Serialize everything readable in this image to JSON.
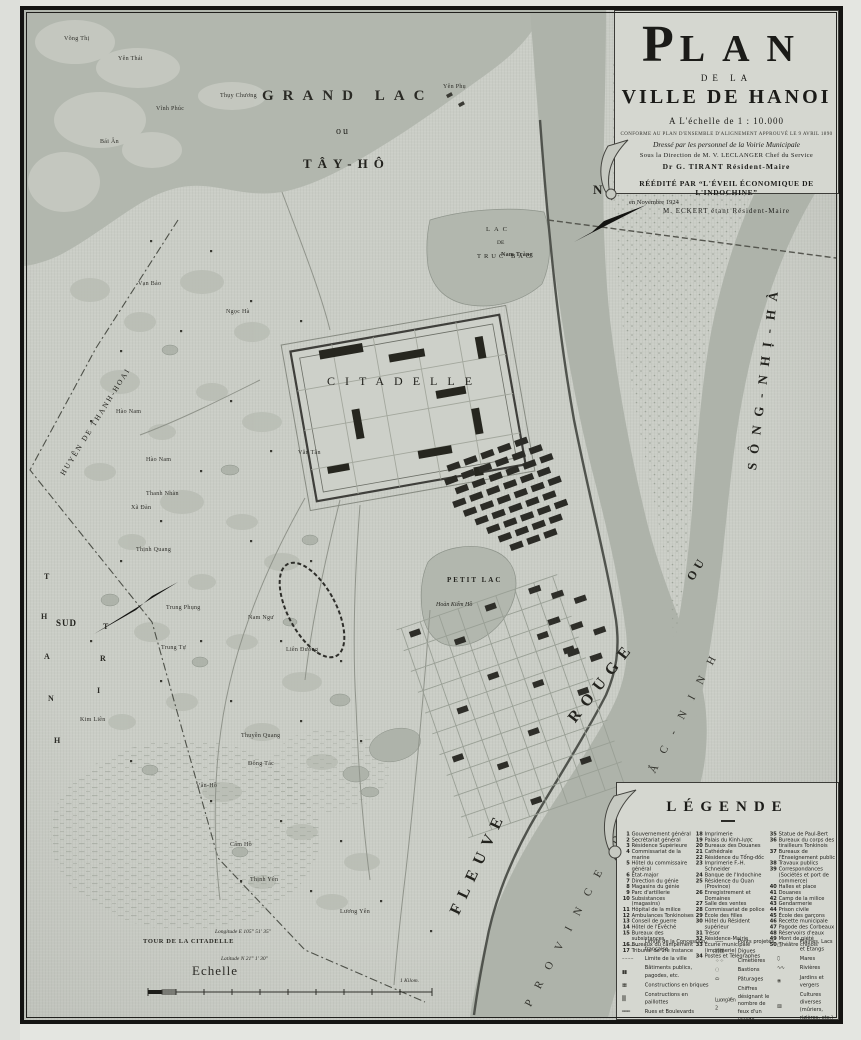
{
  "title_block": {
    "plan_initial": "P",
    "plan_rest": "LAN",
    "de_la": "DE LA",
    "ville": "VILLE DE HANOI",
    "scale_line": "A L'échelle de 1 : 10.000",
    "conforme": "CONFORME AU PLAN D'ENSEMBLE D'ALIGNEMENT APPROUVÉ LE 9 AVRIL 1890",
    "dresse": "Dressé par les personnel de la Voirie Municipale",
    "direction": "Sous la Direction de M. V. LECLANGER Chef du Service",
    "tirant": "Dr G. TIRANT Résident-Maire",
    "reedite": "RÉÉDITÉ PAR “L'ÉVEIL ÉCONOMIQUE DE L'INDOCHINE”",
    "date": "en Novembre 1924",
    "eckert": "M. ECKERT étant Résident-Maire"
  },
  "compass": {
    "north": "N",
    "south": "SUD"
  },
  "water_labels": {
    "grand_lac": "GRAND LAC",
    "ou": "ou",
    "tay_ho": "TÂY-HÔ",
    "truc_bac_1": "LAC",
    "truc_bac_2": "DE",
    "truc_bac_3": "TRUC BAC",
    "petit_lac": "PETIT LAC",
    "hoan_kiem": "Hoàn Kiếm Hồ",
    "fleuve": "FLEUVE",
    "rouge": "ROUGE",
    "ou2": "OU",
    "song_nhi_ha": "SÔNG-NHỊ-HÀ",
    "province": "PROVINCE DE BẮC-NINH"
  },
  "area_labels": {
    "citadelle": "CITADELLE",
    "huyen_thanh_hoai": "HUYÊN DE THANH-HOAI",
    "thanh_letters": [
      "T",
      "H",
      "A",
      "N",
      "H"
    ],
    "tri_letters": [
      "T",
      "R",
      "I"
    ]
  },
  "villages": {
    "vong_thi": "Võng Thị",
    "yen_thai": "Yên Thái",
    "thuy_chuong": "Thụy Chương",
    "bai_an": "Bái Ân",
    "vinh_phuc": "Vĩnh Phúc",
    "van_bao": "Vạn Bảo",
    "ngoc_ha": "Ngọc Hà",
    "yen_phu": "Yên Phụ",
    "nam_trang": "Nam Tràng",
    "van_tan": "Văn Tân",
    "hao_nam1": "Hào Nam",
    "hao_nam2": "Hào Nam",
    "thanh_nhan": "Thanh Nhàn",
    "xa_dan": "Xã Đàn",
    "thinh_quang": "Thịnh Quang",
    "trung_phung": "Trung Phụng",
    "trung_tu": "Trung Tự",
    "kim_lien": "Kim Liên",
    "nam_ngu": "Nam Ngư",
    "lien_duong": "Liên Đường",
    "thuyen_quang": "Thuyền Quang",
    "dong_tac": "Đông Tác",
    "van_ho": "Vân-Hồ",
    "cam_ho": "Cẩm Hồ",
    "thinh_yen": "Thịnh Yên",
    "luong_yen": "Lương Yên"
  },
  "scale_block": {
    "tour": "TOUR DE LA CITADELLE",
    "longitude": "Longitude E 105° 51' 35″",
    "latitude": "Latitude N 21° 1' 30″",
    "echelle": "Echelle",
    "kilometre": "1 Kilom."
  },
  "legend": {
    "title": "LÉGENDE",
    "col1": [
      {
        "n": "1",
        "t": "Gouvernement général"
      },
      {
        "n": "2",
        "t": "Secrétariat général"
      },
      {
        "n": "3",
        "t": "Résidence Supérieure"
      },
      {
        "n": "4",
        "t": "Commissariat de la marine"
      },
      {
        "n": "5",
        "t": "Hôtel du commissaire général"
      },
      {
        "n": "6",
        "t": "État-major"
      },
      {
        "n": "7",
        "t": "Direction du génie"
      },
      {
        "n": "8",
        "t": "Magasins du génie"
      },
      {
        "n": "9",
        "t": "Parc d'artillerie"
      },
      {
        "n": "10",
        "t": "Subsistances (magasins)"
      },
      {
        "n": "11",
        "t": "Hôpital de la milice"
      },
      {
        "n": "12",
        "t": "Ambulances Tonkinoises"
      },
      {
        "n": "13",
        "t": "Conseil de guerre"
      },
      {
        "n": "14",
        "t": "Hôtel de l'Évêché"
      },
      {
        "n": "15",
        "t": "Bureaux des subsistances"
      },
      {
        "n": "16",
        "t": "Bureaux du campement"
      },
      {
        "n": "17",
        "t": "Tribunal de 1re Instance"
      }
    ],
    "col2": [
      {
        "n": "18",
        "t": "Imprimerie"
      },
      {
        "n": "19",
        "t": "Palais du Kinh-lược"
      },
      {
        "n": "20",
        "t": "Bureaux des Douanes"
      },
      {
        "n": "21",
        "t": "Cathédrale"
      },
      {
        "n": "22",
        "t": "Résidence du Tổng-đốc"
      },
      {
        "n": "23",
        "t": "Imprimerie F.-H. Schneider"
      },
      {
        "n": "24",
        "t": "Banque de l'Indochine"
      },
      {
        "n": "25",
        "t": "Résidence du Quan (Province)"
      },
      {
        "n": "26",
        "t": "Enregistrement et Domaines"
      },
      {
        "n": "27",
        "t": "Salle des ventes"
      },
      {
        "n": "28",
        "t": "Commissariat de police"
      },
      {
        "n": "29",
        "t": "École des filles"
      },
      {
        "n": "30",
        "t": "Hôtel du Résident supérieur"
      },
      {
        "n": "31",
        "t": "Trésor"
      },
      {
        "n": "32",
        "t": "Résidence-Mairie"
      },
      {
        "n": "33",
        "t": "Écurie municipale (imprimerie)"
      },
      {
        "n": "34",
        "t": "Postes et Télégraphes"
      }
    ],
    "col3": [
      {
        "n": "35",
        "t": "Statue de Paul-Bert"
      },
      {
        "n": "36",
        "t": "Bureaux du corps des tirailleurs Tonkinois"
      },
      {
        "n": "37",
        "t": "Bureaux de l'Enseignement public"
      },
      {
        "n": "38",
        "t": "Travaux publics"
      },
      {
        "n": "39",
        "t": "Correspondances (Sociétés et port de commerce)"
      },
      {
        "n": "40",
        "t": "Halles et place"
      },
      {
        "n": "41",
        "t": "Douanes"
      },
      {
        "n": "42",
        "t": "Camp de la milice"
      },
      {
        "n": "43",
        "t": "Gendarmerie"
      },
      {
        "n": "44",
        "t": "Prison civile"
      },
      {
        "n": "45",
        "t": "École des garçons"
      },
      {
        "n": "46",
        "t": "Recette municipale"
      },
      {
        "n": "47",
        "t": "Pagode des Corbeaux"
      },
      {
        "n": "48",
        "t": "Réservoirs d'eaux"
      },
      {
        "n": "49",
        "t": "Mont de piété"
      },
      {
        "n": "50",
        "t": "Théâtre chinois"
      }
    ],
    "symbols_col1": [
      {
        "s": "—··—··—",
        "t": "Limite de la Concession française"
      },
      {
        "s": "– – – –",
        "t": "Limite de la ville"
      },
      {
        "s": "▮▮",
        "t": "Bâtiments publics, pagodes, etc."
      },
      {
        "s": "▦",
        "t": "Constructions en briques"
      },
      {
        "s": "▒",
        "t": "Constructions en paillottes"
      },
      {
        "s": "═══",
        "t": "Rues et Boulevards"
      }
    ],
    "symbols_col2": [
      {
        "s": "╌╌╌",
        "t": "Ponts projetés"
      },
      {
        "s": "⟫⟫⟫⟫",
        "t": "Digues"
      },
      {
        "s": "⁘ ⁘",
        "t": "Cimetières"
      },
      {
        "s": "◌",
        "t": "Bastions"
      },
      {
        "s": "⬭",
        "t": "Pâturages"
      },
      {
        "s": "Luong-Yên 2",
        "t": "Chiffres désignant le nombre de feux d'un village"
      }
    ],
    "symbols_col3": [
      {
        "s": "▢",
        "t": "Plaines, Lacs et Étangs"
      },
      {
        "s": "⬯",
        "t": "Mares"
      },
      {
        "s": "∿∿",
        "t": "Rivières"
      },
      {
        "s": "❀",
        "t": "Jardins et vergers"
      },
      {
        "s": "▨",
        "t": "Cultures diverses (mûriers, rizières, etc.)"
      }
    ]
  },
  "colors": {
    "paper": "#cacdc6",
    "water": "#b2b7ae",
    "ink": "#1b1b18",
    "panel": "#d5d7d0"
  }
}
